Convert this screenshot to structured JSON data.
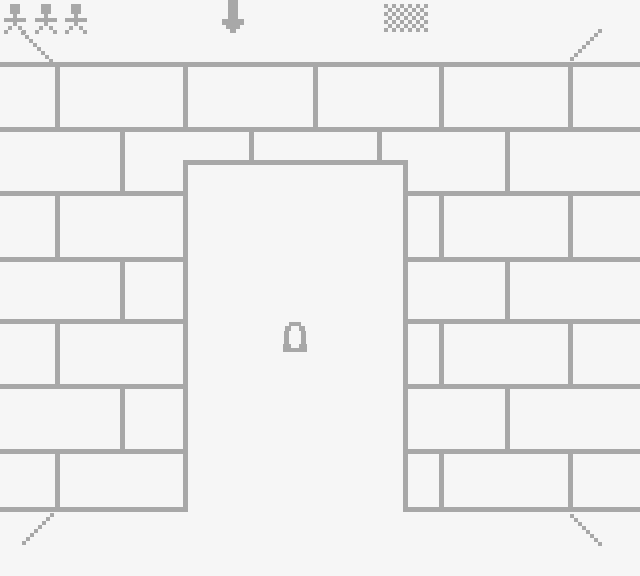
{
  "scene": {
    "label": "pixel brick wall with open doorway",
    "width": 640,
    "height": 576,
    "background_color": "#f6f6f6",
    "sprite_color": "#a8a8a8",
    "mortar_color": "#a8a8a8"
  },
  "hud": {
    "figures": {
      "icon": "person-icon",
      "count": 3,
      "positions": [
        [
          2,
          3
        ],
        [
          33,
          3
        ],
        [
          63,
          3
        ]
      ]
    },
    "down_arrow": {
      "icon": "down-arrow-icon",
      "position": [
        222,
        0
      ]
    },
    "checkerboard": {
      "icon": "checkerboard-icon",
      "position": [
        384,
        4
      ],
      "cols": 11,
      "rows": 7,
      "cell": 4
    }
  },
  "door_glyph": {
    "icon": "omega-icon",
    "position": [
      283,
      322
    ]
  },
  "wall": {
    "thickness": 5,
    "row_lines_y": [
      62,
      127,
      191,
      257,
      319,
      384,
      449,
      507
    ],
    "odd_row_verticals_x": [
      55,
      183,
      313,
      439,
      568
    ],
    "even_row_verticals_x": [
      120,
      249,
      377,
      505
    ],
    "door": {
      "left": 183,
      "right": 403,
      "top": 160
    }
  },
  "trails": [
    {
      "name": "trail-top-left",
      "start": [
        21,
        31
      ],
      "step": [
        4,
        4
      ],
      "count": 8,
      "dot": 4
    },
    {
      "name": "trail-top-right",
      "start": [
        598,
        29
      ],
      "step": [
        -4,
        4
      ],
      "count": 8,
      "dot": 4
    },
    {
      "name": "trail-bottom-left",
      "start": [
        50,
        513
      ],
      "step": [
        -4,
        4
      ],
      "count": 8,
      "dot": 4
    },
    {
      "name": "trail-bottom-right",
      "start": [
        570,
        514
      ],
      "step": [
        4,
        4
      ],
      "count": 8,
      "dot": 4
    }
  ]
}
